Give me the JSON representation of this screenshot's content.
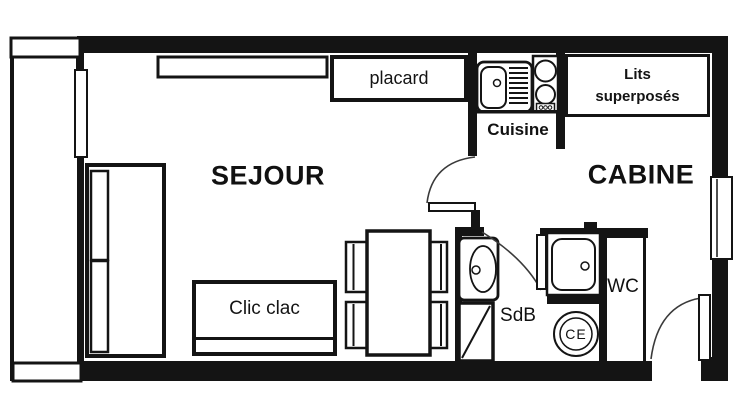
{
  "plan_title": "studio-floor-plan",
  "colors": {
    "ink": "#141414",
    "paper": "#ffffff"
  },
  "rooms": {
    "living": "SEJOUR",
    "cabin": "CABINE",
    "kitchen": "Cuisine",
    "bathroom": "SdB",
    "toilet": "WC"
  },
  "furniture": {
    "closet": "placard",
    "bunk_beds_line1": "Lits",
    "bunk_beds_line2": "superposés",
    "sofa_bed": "Clic clac",
    "water_heater": "CE"
  }
}
